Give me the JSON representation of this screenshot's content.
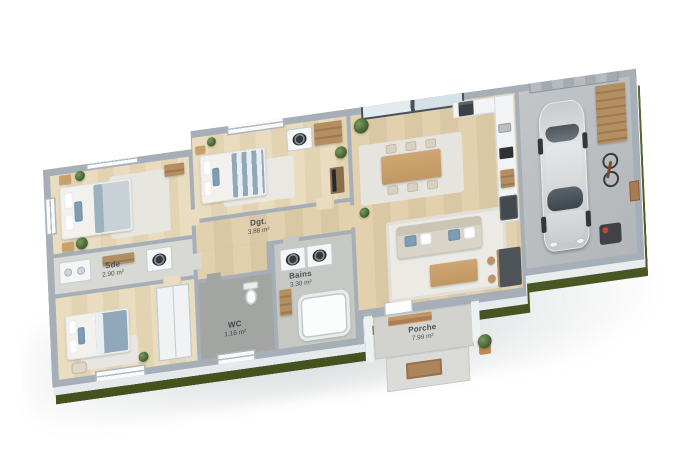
{
  "image_type": "3d-rendered floor plan of a single-storey house with garage",
  "labels": {
    "dgt": {
      "name": "Dgt.",
      "area": "3.88 m²"
    },
    "sde": {
      "name": "Sde",
      "area": "2.90 m²"
    },
    "wc": {
      "name": "WC",
      "area": "1.16 m²"
    },
    "bains": {
      "name": "Bains",
      "area": "3.30 m²"
    },
    "porche": {
      "name": "Porche",
      "area": "7.99 m²"
    }
  },
  "palette": {
    "background": "#ffffff",
    "wall_top": "#a6afb7",
    "wall_face": "#f3f5f6",
    "wood_floor": "#e0cfae",
    "concrete_floor": "#c6c8c4",
    "grass": "#4d5c2a",
    "car_body": "#d5d7d9",
    "sofa": "#dad4c8",
    "accent_blue": "#7e9db4",
    "wood_furniture": "#c9a06c"
  }
}
